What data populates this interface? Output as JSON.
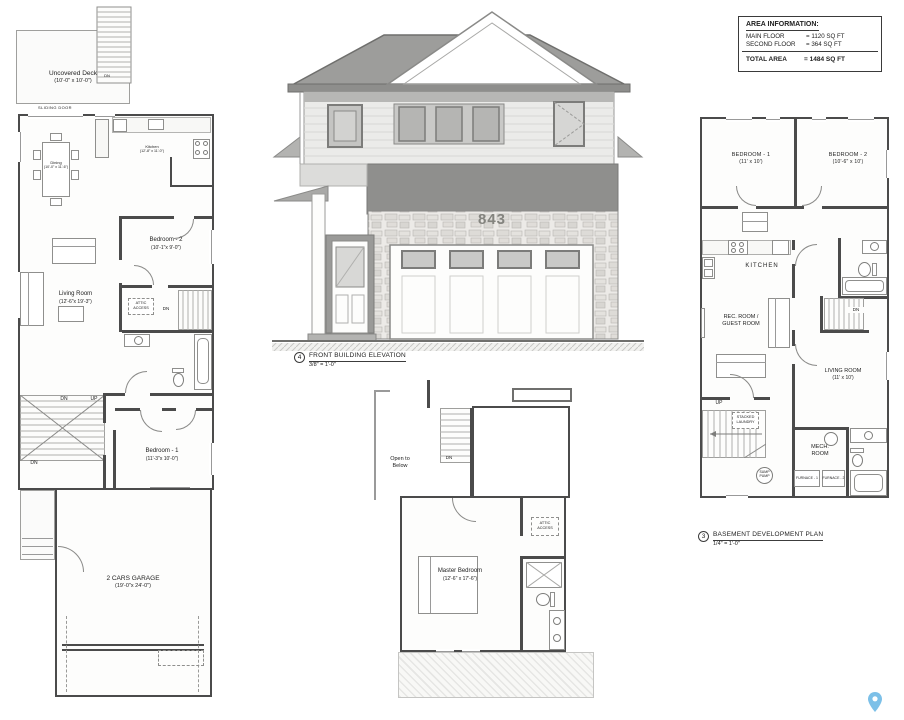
{
  "colors": {
    "pin": "#7cc0e8",
    "wall": "#4b4b4b",
    "roof": "#9d9d9b"
  },
  "area_info": {
    "title": "AREA INFORMATION:",
    "rows": [
      {
        "label": "MAIN FLOOR",
        "value": "= 1120 SQ FT"
      },
      {
        "label": "SECOND FLOOR",
        "value": "= 364 SQ FT"
      }
    ],
    "total": {
      "label": "TOTAL AREA",
      "value": "= 1484 SQ FT"
    }
  },
  "main_floor": {
    "deck_name": "Uncovered Deck",
    "deck_dims": "(10'-0\" x 10'-0\")",
    "sliding_door": "SLIDING DOOR",
    "deck_stairs_dn": "DN",
    "dining_name": "Dining",
    "dining_dims": "(10'-0\" x 11'-6\")",
    "kitchen_name": "Kitchen",
    "kitchen_dims": "(12'-8\" x 11'-0\")",
    "bedroom2_name": "Bedroom - 2",
    "bedroom2_dims": "(10'-1\"x 9'-0\")",
    "living_name": "Living Room",
    "living_dims": "(12'-6\"x 19'-3\")",
    "attic_line1": "ATTIC",
    "attic_line2": "ACCESS",
    "hall_dn": "DN",
    "stair_dn": "DN",
    "stair_up": "UP",
    "stair_dn2": "DN",
    "bedroom1_name": "Bedroom - 1",
    "bedroom1_dims": "(11'-3\"x 10'-0\")",
    "garage_name": "2 CARS GARAGE",
    "garage_dims": "(19'-0\"x 24'-0\")"
  },
  "elevation": {
    "house_number": "843",
    "callout": "4",
    "title": "FRONT BUILDING ELEVATION",
    "scale": "3/8\" = 1'-0\""
  },
  "second_floor": {
    "open_line1": "Open to",
    "open_line2": "Below",
    "stair_dn": "DN",
    "master_name": "Master Bedroom",
    "master_dims": "(12'-6\" x 17'-6\")",
    "attic_line1": "ATTIC",
    "attic_line2": "ACCESS"
  },
  "basement": {
    "callout": "3",
    "title": "BASEMENT DEVELOPMENT PLAN",
    "scale": "1/4\" = 1'-0\"",
    "bedroom1_name": "BEDROOM - 1",
    "bedroom1_dims": "(11' x 10')",
    "bedroom2_name": "BEDROOM - 2",
    "bedroom2_dims": "(10'-6\" x 10')",
    "kitchen": "KITCHEN",
    "rec_line1": "REC. ROOM /",
    "rec_line2": "GUEST ROOM",
    "stair_dn": "DN",
    "living_name": "LIVING ROOM",
    "living_dims": "(11' x 10')",
    "stair_up": "UP",
    "laundry_line1": "STACKED",
    "laundry_line2": "LAUNDRY",
    "mech_line1": "MECH.",
    "mech_line2": "ROOM",
    "sump_line1": "SUMP",
    "sump_line2": "PUMP",
    "furnace1": "FURNACE - 1",
    "furnace2": "FURNACE - 2"
  }
}
